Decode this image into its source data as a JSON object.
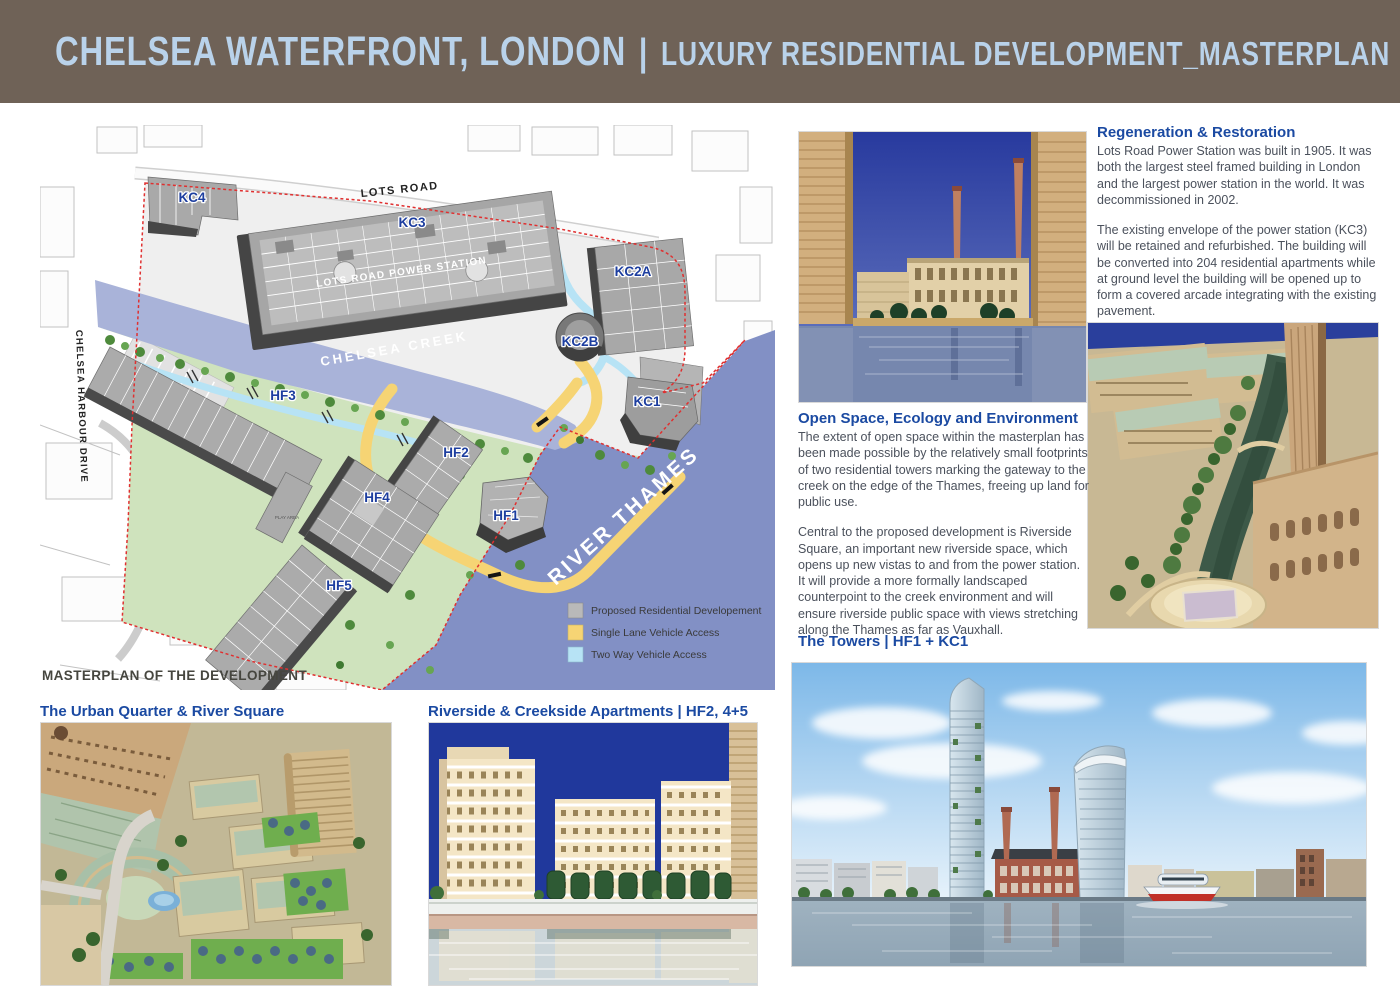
{
  "header": {
    "title": "CHELSEA WATERFRONT, LONDON",
    "divider": "|",
    "subtitle": "LUXURY RESIDENTIAL DEVELOPMENT_MASTERPLAN"
  },
  "map": {
    "caption": "MASTERPLAN OF THE DEVELOPMENT",
    "labels": {
      "lots_road": "LOTS ROAD",
      "power_station": "LOTS ROAD POWER STATION",
      "chelsea_creek": "CHELSEA CREEK",
      "river_thames": "RIVER THAMES",
      "chelsea_harbour_drive": "CHELSEA HARBOUR DRIVE",
      "play_area": "PLAY AREA"
    },
    "buildings": [
      "KC4",
      "KC3",
      "KC2A",
      "KC2B",
      "KC1",
      "HF3",
      "HF2",
      "HF4",
      "HF1",
      "HF5"
    ],
    "legend": [
      {
        "label": "Proposed Residential Developement",
        "color": "#b9b9b9"
      },
      {
        "label": "Single Lane Vehicle Access",
        "color": "#f6d474"
      },
      {
        "label": "Two Way Vehicle Access",
        "color": "#b7e3f5"
      }
    ]
  },
  "sections": {
    "regeneration": {
      "heading": "Regeneration & Restoration",
      "para1": "Lots Road Power Station was built in 1905. It was both the largest steel framed building in London and the largest power station in the world. It was decommissioned in 2002.",
      "para2": "The existing envelope of the power station (KC3) will be retained and refurbished. The building will be converted into 204 residential apartments while at ground level the building will be opened up to form a covered arcade integrating with the existing pavement."
    },
    "open_space": {
      "heading": "Open Space, Ecology and Environment",
      "para1": "The extent of open space within the masterplan has been made possible by the relatively small footprints of two residential towers marking the gateway to the creek on the edge of the Thames, freeing up land for public use.",
      "para2": "Central to the proposed development is Riverside Square, an important new riverside space, which opens up new vistas to and from the power station. It will provide a more formally landscaped counterpoint to the creek environment and will ensure riverside public space with views stretching along the Thames as far as Vauxhall."
    },
    "towers": {
      "heading": "The Towers | HF1 + KC1"
    },
    "urban_quarter": {
      "heading": "The Urban Quarter & River Square"
    },
    "riverside": {
      "heading": "Riverside & Creekside Apartments | HF2, 4+5"
    }
  },
  "colors": {
    "header_bg": "#6f6257",
    "header_text": "#b9d2ea",
    "heading_blue": "#1b4aa2",
    "body_text": "#4b515c",
    "map_label_blue": "#1d3e9f",
    "river": "#8290c5",
    "creek": "#a9b3d9",
    "park_green": "#cfe3bd",
    "boundary_red": "#e03030"
  }
}
